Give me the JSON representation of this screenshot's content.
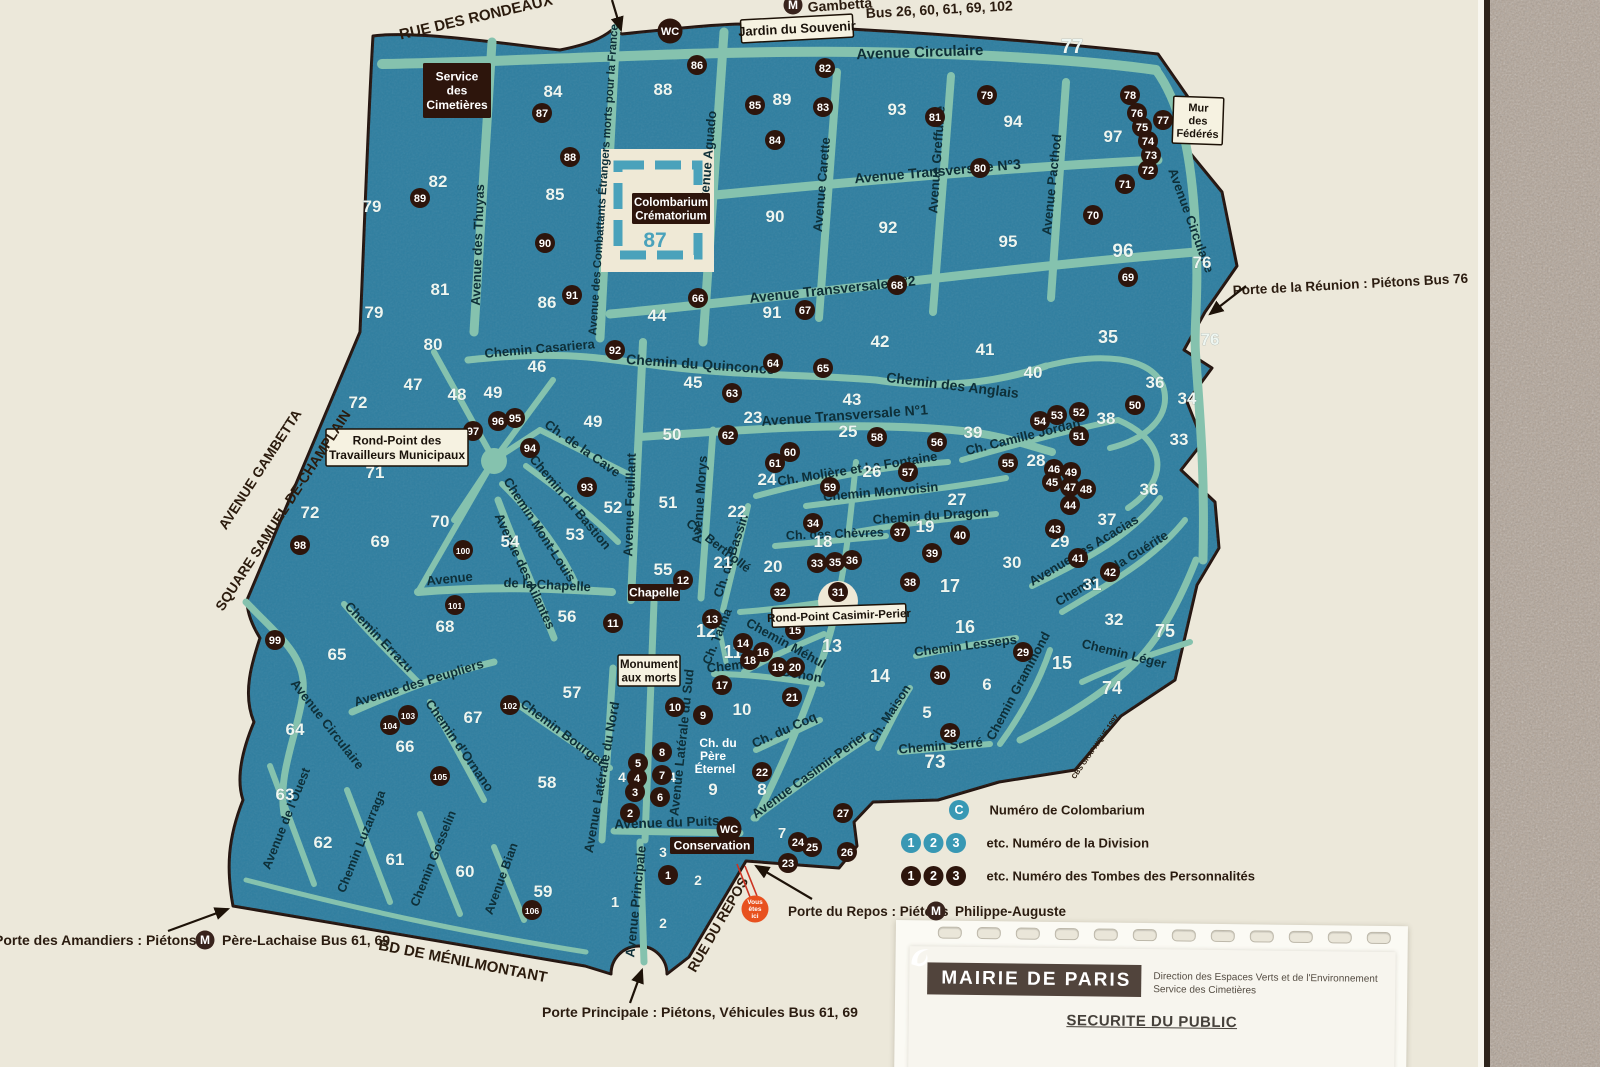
{
  "colors": {
    "cream": "#ece8da",
    "map": "#2e7ea0",
    "road": "#85c2ae",
    "dark_circle": "#2d150c",
    "teal_circle": "#3898b4",
    "sign_white": "#f6f2e1",
    "orange": "#e8511f",
    "stone": "#b1a396",
    "street_text": "#0e2f38",
    "outside_text": "#2b1b0d"
  },
  "wc_label": "WC",
  "wc": [
    [
      670,
      31
    ],
    [
      729,
      829
    ]
  ],
  "metro_icons": [
    [
      793,
      5
    ],
    [
      205,
      940
    ],
    [
      936,
      911
    ]
  ],
  "metro_letter": "M",
  "you_are_here": {
    "lines": [
      "Vous",
      "êtes",
      "ici"
    ],
    "x": 755,
    "y": 909
  },
  "colombarium_number": {
    "n": "87",
    "x": 655,
    "y": 247
  },
  "outside_labels": [
    [
      "RUE DES RONDEAUX",
      477,
      22,
      -13,
      15
    ],
    [
      "BD DE MÉNILMONTANT",
      462,
      966,
      11,
      15
    ],
    [
      "RUE DU REPOS",
      722,
      927,
      -60,
      14
    ],
    [
      "AVENUE GAMBETTA",
      264,
      472,
      -57,
      14
    ],
    [
      "SQUARE SAMUEL-DE-CHAMPLAIN",
      287,
      513,
      -57,
      14
    ],
    [
      "CBS GRAPHIQUE 1997",
      1097,
      748,
      -55,
      7
    ]
  ],
  "annotations": [
    [
      "Gambetta",
      808,
      12,
      -4,
      14
    ],
    [
      "Bus 26, 60, 61, 69, 102",
      866,
      18,
      -3,
      14
    ],
    [
      "Porte de la Réunion   :   Piétons    Bus 76",
      1233,
      295,
      -3,
      13.5
    ],
    [
      "Porte des Amandiers   :   Piétons",
      -6,
      945,
      0,
      14
    ],
    [
      "Père-Lachaise     Bus 61, 69",
      222,
      945,
      0,
      14
    ],
    [
      "Porte Principale    :    Piétons, Véhicules      Bus 61, 69",
      542,
      1017,
      0,
      14
    ],
    [
      "Porte du Repos   :   Piétons",
      788,
      916,
      0,
      13.5
    ],
    [
      "Philippe-Auguste",
      955,
      916,
      0,
      13.5
    ]
  ],
  "signs": [
    {
      "lines": [
        "Jardin du Souvenir"
      ],
      "x": 741,
      "y": 17,
      "w": 112,
      "h": 23,
      "fs": 13,
      "r": -3
    },
    {
      "lines": [
        "Mur",
        "des",
        "Fédérés"
      ],
      "x": 1173,
      "y": 97,
      "w": 50,
      "h": 47,
      "fs": 11,
      "r": 2
    },
    {
      "lines": [
        "Rond-Point des",
        "Travailleurs Municipaux"
      ],
      "x": 326,
      "y": 429,
      "w": 142,
      "h": 37,
      "fs": 12,
      "r": 0
    },
    {
      "lines": [
        "Rond-Point Casimir-Perier"
      ],
      "x": 772,
      "y": 606,
      "w": 134,
      "h": 19,
      "fs": 11.5,
      "r": -2
    },
    {
      "lines": [
        "Monument",
        "aux morts"
      ],
      "x": 618,
      "y": 655,
      "w": 62,
      "h": 31,
      "fs": 11.5,
      "r": 0
    }
  ],
  "dark_signs": [
    {
      "lines": [
        "Service",
        "des",
        "Cimetières"
      ],
      "x": 423,
      "y": 63,
      "w": 68,
      "h": 55,
      "fs": 12,
      "r": 0
    },
    {
      "lines": [
        "Colombarium",
        "Crématorium"
      ],
      "x": 632,
      "y": 193,
      "w": 78,
      "h": 31,
      "fs": 11.5,
      "r": 0
    },
    {
      "lines": [
        "Chapelle"
      ],
      "x": 628,
      "y": 584,
      "w": 52,
      "h": 17,
      "fs": 12,
      "r": 0
    },
    {
      "lines": [
        "Conservation"
      ],
      "x": 670,
      "y": 837,
      "w": 84,
      "h": 17,
      "fs": 12,
      "r": 0
    }
  ],
  "legend": {
    "rows": [
      {
        "type": "teal",
        "symbols": [
          "C"
        ],
        "label": "Numéro de Colombarium",
        "x": 959,
        "y": 810
      },
      {
        "type": "teal",
        "symbols": [
          "1",
          "2",
          "3"
        ],
        "label": "etc.   Numéro de la Division",
        "x": 911,
        "y": 843
      },
      {
        "type": "dark",
        "symbols": [
          "1",
          "2",
          "3"
        ],
        "label": "etc.   Numéro des Tombes des Personnalités",
        "x": 911,
        "y": 876
      }
    ]
  },
  "document": {
    "brand": "MAIRIE DE PARIS",
    "dept_line1": "Direction des Espaces Verts et de l'Environnement",
    "dept_line2": "Service des Cimetières",
    "title": "SECURITE DU PUBLIC"
  },
  "street_labels": [
    [
      "Avenue Circulaire",
      920,
      57,
      -2,
      15
    ],
    [
      "Avenue Transversale N°3",
      938,
      176,
      -5,
      14
    ],
    [
      "Avenue Transversale N°2",
      833,
      294,
      -6,
      14
    ],
    [
      "Avenue Transversale N°1",
      845,
      420,
      -4,
      14
    ],
    [
      "Chemin du Quinconce",
      700,
      369,
      4,
      14
    ],
    [
      "Chemin des Anglais",
      952,
      390,
      7,
      14
    ],
    [
      "Chemin Casariera",
      540,
      353,
      -5,
      13
    ],
    [
      "Avenue des Thuyas",
      482,
      245,
      -88,
      13
    ],
    [
      "Avenue des Combattants Étrangers morts pour la France",
      607,
      180,
      -86,
      11.5
    ],
    [
      "Avenue Aguado",
      712,
      160,
      -85,
      13
    ],
    [
      "Avenue Carette",
      826,
      185,
      -85,
      13
    ],
    [
      "Avenue Greffulhe",
      941,
      160,
      -86,
      13
    ],
    [
      "Avenue Pacthod",
      1056,
      185,
      -84,
      13
    ],
    [
      "Avenue Circulaire",
      1187,
      222,
      70,
      13
    ],
    [
      "Ch. de la Cave",
      580,
      452,
      35,
      13
    ],
    [
      "Chemin du Bastion",
      567,
      505,
      50,
      13
    ],
    [
      "Chemin Mont-Louis",
      536,
      532,
      57,
      13
    ],
    [
      "Avenue Feuillant",
      634,
      505,
      -88,
      13
    ],
    [
      "Avenue Morys",
      704,
      500,
      -86,
      13
    ],
    [
      "Ch. du Bassin",
      735,
      557,
      -72,
      13
    ],
    [
      "Ch. Berthollé",
      716,
      549,
      38,
      12.5
    ],
    [
      "Avenue des Ailantes",
      521,
      573,
      65,
      13
    ],
    [
      "Avenue",
      450,
      583,
      -6,
      13
    ],
    [
      "de la Chapelle",
      547,
      589,
      3,
      13
    ],
    [
      "Ch. Molière et La Fontaine",
      858,
      473,
      -9,
      13
    ],
    [
      "Chemin Monvoisin",
      881,
      496,
      -5,
      13
    ],
    [
      "Chemin du Dragon",
      931,
      520,
      -4,
      13
    ],
    [
      "Ch. des Chèvres",
      835,
      538,
      -2,
      12.5
    ],
    [
      "Ch. Camille Jordan",
      1024,
      441,
      -14,
      13
    ],
    [
      "Avenue des Acacias",
      1086,
      554,
      -31,
      13
    ],
    [
      "Chemin de la Guérite",
      1114,
      572,
      -32,
      13
    ],
    [
      "Chemin Léger",
      1123,
      658,
      14,
      13
    ],
    [
      "Chemin Lesseps",
      966,
      650,
      -7,
      13
    ],
    [
      "Chemin Grammond",
      1022,
      688,
      -62,
      13
    ],
    [
      "Ch. Maison",
      893,
      716,
      -57,
      12.5
    ],
    [
      "Chemin Serré",
      941,
      750,
      -5,
      13
    ],
    [
      "Ch. du Coq",
      786,
      734,
      -24,
      13
    ],
    [
      "Avenue Casimir-Perier",
      812,
      778,
      -36,
      13
    ],
    [
      "Chemin Méhul",
      784,
      647,
      29,
      13
    ],
    [
      "Chemin",
      731,
      670,
      -6,
      13
    ],
    [
      "Denon",
      801,
      679,
      10,
      13
    ],
    [
      "Ch. Talma",
      721,
      638,
      -68,
      12.5
    ],
    [
      "Ch. du",
      718,
      747,
      0,
      12,
      "#ffffff"
    ],
    [
      "Père",
      713,
      760,
      0,
      12,
      "#ffffff"
    ],
    [
      "Éternel",
      715,
      773,
      0,
      12,
      "#ffffff"
    ],
    [
      "Avenue Latérale du Nord",
      606,
      778,
      -80,
      13
    ],
    [
      "Avenue Latérale du Sud",
      686,
      743,
      -84,
      13
    ],
    [
      "Avenue du Puits",
      667,
      827,
      -2,
      13.5
    ],
    [
      "Avenue Principale",
      640,
      902,
      -84,
      13
    ],
    [
      "Avenue Bian",
      505,
      880,
      -70,
      12.5
    ],
    [
      "Chemin Gosselin",
      437,
      860,
      -68,
      12.5
    ],
    [
      "Chemin Luzarraga",
      365,
      843,
      -68,
      12.5
    ],
    [
      "Avenue de l'Ouest",
      290,
      820,
      -68,
      12.5
    ],
    [
      "Avenue Circulaire",
      324,
      727,
      52,
      13
    ],
    [
      "Chemin Errazu",
      376,
      640,
      46,
      13
    ],
    [
      "Avenue des Peupliers",
      420,
      687,
      -17,
      13
    ],
    [
      "Chemin d'Ornano",
      456,
      748,
      55,
      13
    ],
    [
      "Chemin Bourget",
      560,
      736,
      37,
      13
    ]
  ],
  "divisions": [
    [
      "79",
      372,
      212
    ],
    [
      "79",
      374,
      318
    ],
    [
      "82",
      438,
      187
    ],
    [
      "81",
      440,
      295
    ],
    [
      "80",
      433,
      350
    ],
    [
      "84",
      553,
      97
    ],
    [
      "85",
      555,
      200
    ],
    [
      "86",
      547,
      308
    ],
    [
      "88",
      663,
      95
    ],
    [
      "89",
      782,
      105
    ],
    [
      "90",
      775,
      222
    ],
    [
      "91",
      772,
      318
    ],
    [
      "92",
      888,
      233
    ],
    [
      "93",
      897,
      115
    ],
    [
      "94",
      1013,
      127
    ],
    [
      "95",
      1008,
      247
    ],
    [
      "96",
      1123,
      257,
      19
    ],
    [
      "97",
      1113,
      142
    ],
    [
      "77",
      1072,
      53,
      20
    ],
    [
      "76",
      1202,
      268
    ],
    [
      "76",
      1210,
      345
    ],
    [
      "44",
      657,
      321
    ],
    [
      "46",
      537,
      372
    ],
    [
      "45",
      693,
      388
    ],
    [
      "47",
      413,
      390
    ],
    [
      "48",
      457,
      400
    ],
    [
      "49",
      493,
      398
    ],
    [
      "49",
      593,
      427
    ],
    [
      "50",
      672,
      440
    ],
    [
      "43",
      852,
      405
    ],
    [
      "42",
      880,
      347
    ],
    [
      "41",
      985,
      355
    ],
    [
      "40",
      1033,
      378
    ],
    [
      "35",
      1108,
      343,
      18
    ],
    [
      "36",
      1155,
      388
    ],
    [
      "34",
      1187,
      404
    ],
    [
      "38",
      1106,
      424
    ],
    [
      "33",
      1179,
      445
    ],
    [
      "39",
      973,
      438
    ],
    [
      "25",
      848,
      437
    ],
    [
      "23",
      753,
      423
    ],
    [
      "24",
      767,
      485
    ],
    [
      "26",
      872,
      477
    ],
    [
      "27",
      957,
      505
    ],
    [
      "28",
      1036,
      466
    ],
    [
      "36",
      1149,
      495
    ],
    [
      "37",
      1107,
      525
    ],
    [
      "22",
      737,
      517
    ],
    [
      "51",
      668,
      508
    ],
    [
      "52",
      613,
      513
    ],
    [
      "53",
      575,
      540
    ],
    [
      "54",
      510,
      547
    ],
    [
      "19",
      925,
      532
    ],
    [
      "18",
      823,
      547
    ],
    [
      "20",
      773,
      572
    ],
    [
      "21",
      723,
      568
    ],
    [
      "29",
      1060,
      547
    ],
    [
      "30",
      1012,
      568
    ],
    [
      "31",
      1092,
      590
    ],
    [
      "32",
      1114,
      625
    ],
    [
      "75",
      1165,
      637,
      18
    ],
    [
      "17",
      950,
      592,
      18
    ],
    [
      "16",
      965,
      633,
      18
    ],
    [
      "15",
      1062,
      669,
      18
    ],
    [
      "74",
      1112,
      694,
      18
    ],
    [
      "14",
      880,
      682,
      18
    ],
    [
      "13",
      832,
      652,
      18
    ],
    [
      "12",
      706,
      637,
      18
    ],
    [
      "11",
      733,
      658,
      18
    ],
    [
      "10",
      742,
      715
    ],
    [
      "9",
      713,
      795
    ],
    [
      "8",
      762,
      795
    ],
    [
      "6",
      987,
      690
    ],
    [
      "5",
      927,
      718
    ],
    [
      "73",
      935,
      768,
      19
    ],
    [
      "7",
      782,
      838,
      15
    ],
    [
      "4",
      622,
      782,
      14
    ],
    [
      "4",
      672,
      782,
      14
    ],
    [
      "3",
      663,
      857,
      14
    ],
    [
      "2",
      698,
      885,
      14
    ],
    [
      "2",
      663,
      928,
      14
    ],
    [
      "1",
      615,
      907,
      15
    ],
    [
      "55",
      663,
      575
    ],
    [
      "56",
      567,
      622
    ],
    [
      "57",
      572,
      698
    ],
    [
      "58",
      547,
      788
    ],
    [
      "59",
      543,
      897
    ],
    [
      "60",
      465,
      877
    ],
    [
      "61",
      395,
      865
    ],
    [
      "62",
      323,
      848
    ],
    [
      "63",
      285,
      800
    ],
    [
      "64",
      295,
      735
    ],
    [
      "65",
      337,
      660
    ],
    [
      "66",
      405,
      752
    ],
    [
      "67",
      473,
      723
    ],
    [
      "68",
      445,
      632
    ],
    [
      "69",
      380,
      547
    ],
    [
      "70",
      440,
      527
    ],
    [
      "71",
      375,
      478
    ],
    [
      "72",
      358,
      408
    ],
    [
      "72",
      310,
      518
    ]
  ],
  "tombs": [
    [
      87,
      542,
      113
    ],
    [
      88,
      570,
      157
    ],
    [
      89,
      420,
      198
    ],
    [
      90,
      545,
      243
    ],
    [
      91,
      572,
      295
    ],
    [
      92,
      615,
      350
    ],
    [
      86,
      697,
      65
    ],
    [
      85,
      755,
      105
    ],
    [
      84,
      775,
      140
    ],
    [
      83,
      823,
      107
    ],
    [
      82,
      825,
      68
    ],
    [
      81,
      935,
      117
    ],
    [
      80,
      980,
      168
    ],
    [
      79,
      987,
      95
    ],
    [
      78,
      1130,
      95
    ],
    [
      77,
      1163,
      120
    ],
    [
      76,
      1137,
      113
    ],
    [
      75,
      1142,
      127
    ],
    [
      74,
      1148,
      141
    ],
    [
      73,
      1151,
      155
    ],
    [
      72,
      1148,
      170
    ],
    [
      71,
      1125,
      184
    ],
    [
      70,
      1093,
      215
    ],
    [
      69,
      1128,
      277
    ],
    [
      68,
      897,
      285
    ],
    [
      67,
      805,
      310
    ],
    [
      66,
      698,
      298
    ],
    [
      65,
      823,
      368
    ],
    [
      64,
      773,
      363
    ],
    [
      63,
      732,
      393
    ],
    [
      62,
      728,
      435
    ],
    [
      61,
      775,
      463
    ],
    [
      60,
      790,
      452
    ],
    [
      59,
      830,
      487
    ],
    [
      58,
      877,
      437
    ],
    [
      57,
      908,
      472
    ],
    [
      56,
      937,
      442
    ],
    [
      55,
      1008,
      463
    ],
    [
      54,
      1040,
      421
    ],
    [
      53,
      1057,
      415
    ],
    [
      52,
      1079,
      412
    ],
    [
      51,
      1079,
      436
    ],
    [
      50,
      1135,
      405
    ],
    [
      49,
      1071,
      472
    ],
    [
      48,
      1086,
      489
    ],
    [
      47,
      1070,
      487
    ],
    [
      46,
      1054,
      469
    ],
    [
      45,
      1052,
      482
    ],
    [
      44,
      1070,
      505
    ],
    [
      43,
      1055,
      529
    ],
    [
      42,
      1110,
      572
    ],
    [
      41,
      1078,
      558
    ],
    [
      40,
      960,
      535
    ],
    [
      39,
      932,
      553
    ],
    [
      38,
      910,
      582
    ],
    [
      37,
      900,
      532
    ],
    [
      36,
      852,
      560
    ],
    [
      35,
      835,
      562
    ],
    [
      34,
      813,
      523
    ],
    [
      33,
      817,
      563
    ],
    [
      32,
      780,
      592
    ],
    [
      31,
      838,
      592
    ],
    [
      30,
      940,
      675
    ],
    [
      29,
      1023,
      652
    ],
    [
      28,
      950,
      733
    ],
    [
      27,
      843,
      813
    ],
    [
      26,
      847,
      852
    ],
    [
      25,
      812,
      847
    ],
    [
      24,
      798,
      842
    ],
    [
      23,
      788,
      863
    ],
    [
      22,
      762,
      772
    ],
    [
      21,
      792,
      697
    ],
    [
      20,
      795,
      667
    ],
    [
      19,
      778,
      667
    ],
    [
      18,
      750,
      660
    ],
    [
      17,
      722,
      685
    ],
    [
      16,
      763,
      652
    ],
    [
      15,
      795,
      630
    ],
    [
      14,
      743,
      643
    ],
    [
      13,
      712,
      619
    ],
    [
      12,
      683,
      580
    ],
    [
      11,
      613,
      623
    ],
    [
      10,
      675,
      707
    ],
    [
      9,
      703,
      715
    ],
    [
      8,
      662,
      752
    ],
    [
      7,
      662,
      775
    ],
    [
      6,
      660,
      797
    ],
    [
      5,
      638,
      763
    ],
    [
      4,
      637,
      778
    ],
    [
      3,
      635,
      792
    ],
    [
      2,
      630,
      813
    ],
    [
      1,
      668,
      875
    ],
    [
      93,
      587,
      487
    ],
    [
      94,
      530,
      448
    ],
    [
      95,
      515,
      418
    ],
    [
      96,
      498,
      421
    ],
    [
      97,
      473,
      431
    ],
    [
      98,
      300,
      545
    ],
    [
      99,
      275,
      640
    ],
    [
      100,
      463,
      550
    ],
    [
      101,
      455,
      605
    ],
    [
      102,
      510,
      705
    ],
    [
      103,
      408,
      715
    ],
    [
      104,
      390,
      725
    ],
    [
      105,
      440,
      776
    ],
    [
      106,
      532,
      910
    ]
  ]
}
